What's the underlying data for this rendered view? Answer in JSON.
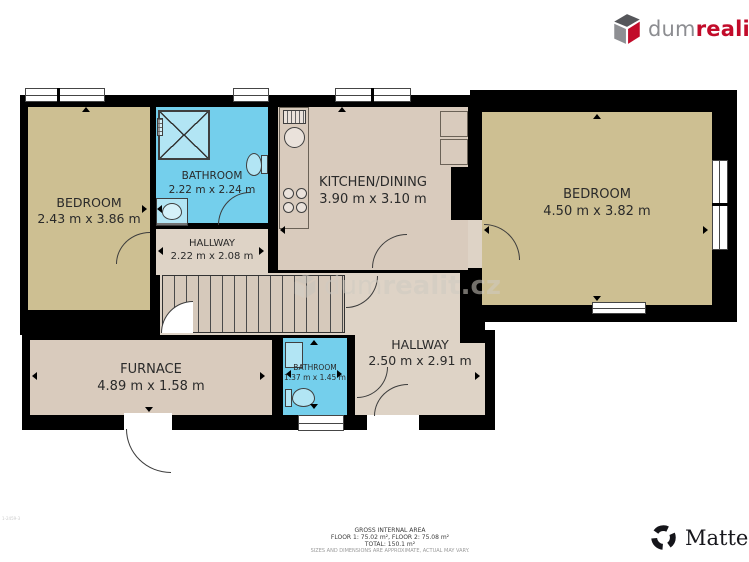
{
  "brand": {
    "dum": "dum",
    "realit": "realit.cz"
  },
  "watermark": {
    "dum": "dum",
    "realit": "realit.cz"
  },
  "rooms": {
    "bedroom_left": {
      "label": "BEDROOM",
      "dims": "2.43 m x 3.86 m"
    },
    "bathroom_top": {
      "label": "BATHROOM",
      "dims": "2.22 m x 2.24 m"
    },
    "hallway_top": {
      "label": "HALLWAY",
      "dims": "2.22 m x 2.08 m"
    },
    "kitchen": {
      "label": "KITCHEN/DINING",
      "dims": "3.90 m x 3.10 m"
    },
    "bedroom_right": {
      "label": "BEDROOM",
      "dims": "4.50 m x 3.82 m"
    },
    "furnace": {
      "label": "FURNACE",
      "dims": "4.89 m x 1.58 m"
    },
    "bathroom_bottom": {
      "label": "BATHROOM",
      "dims": "1.37 m x 1.45 m"
    },
    "hallway_bottom": {
      "label": "HALLWAY",
      "dims": "2.50 m x 2.91 m"
    }
  },
  "footer": {
    "title": "GROSS INTERNAL AREA",
    "floors": "FLOOR 1: 75.02 m², FLOOR 2: 75.08 m²",
    "total": "TOTAL: 150.1 m²",
    "disclaimer": "SIZES AND DIMENSIONS ARE APPROXIMATE, ACTUAL MAY VARY.",
    "code": "1-2459-3"
  },
  "matterport": {
    "label": "Matterport"
  },
  "colors": {
    "wall": "#000000",
    "room_tan": "#cdbf92",
    "room_blue": "#74cfec",
    "room_beige": "#d9cbbd",
    "room_hall": "#ded3c6",
    "brand_red": "#c20b2a",
    "brand_gray": "#8c8d91",
    "matterport_black": "#17171c"
  }
}
